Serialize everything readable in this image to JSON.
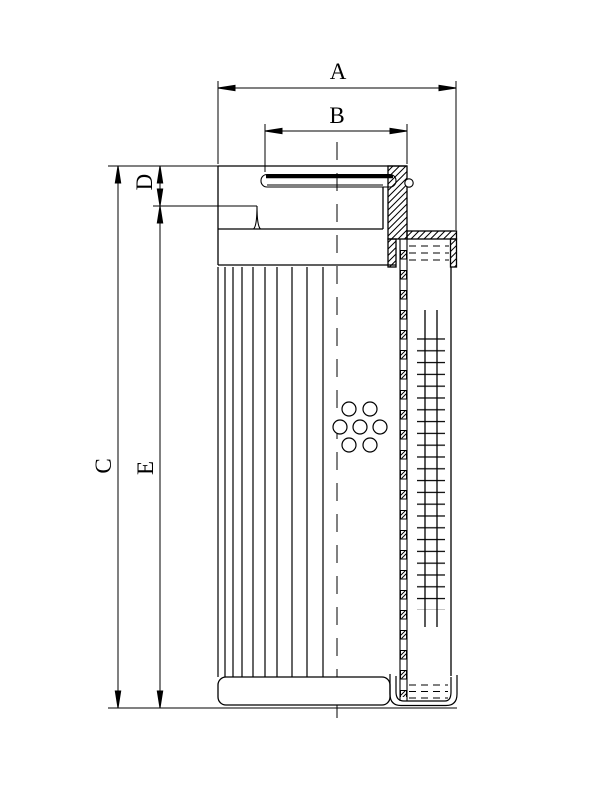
{
  "page": {
    "background": "#ffffff",
    "ink": "#000000"
  },
  "drawing": {
    "kind": "technical cross-section drawing",
    "labels": {
      "A": "A",
      "B": "B",
      "C": "C",
      "D": "D",
      "E": "E"
    },
    "dimensions": [
      {
        "label": "A",
        "orientation": "horizontal",
        "position": "top-outer"
      },
      {
        "label": "B",
        "orientation": "horizontal",
        "position": "top-inner"
      },
      {
        "label": "C",
        "orientation": "vertical",
        "position": "left-outer"
      },
      {
        "label": "D",
        "orientation": "vertical",
        "position": "left-upper"
      },
      {
        "label": "E",
        "orientation": "vertical",
        "position": "left-inner"
      }
    ]
  }
}
